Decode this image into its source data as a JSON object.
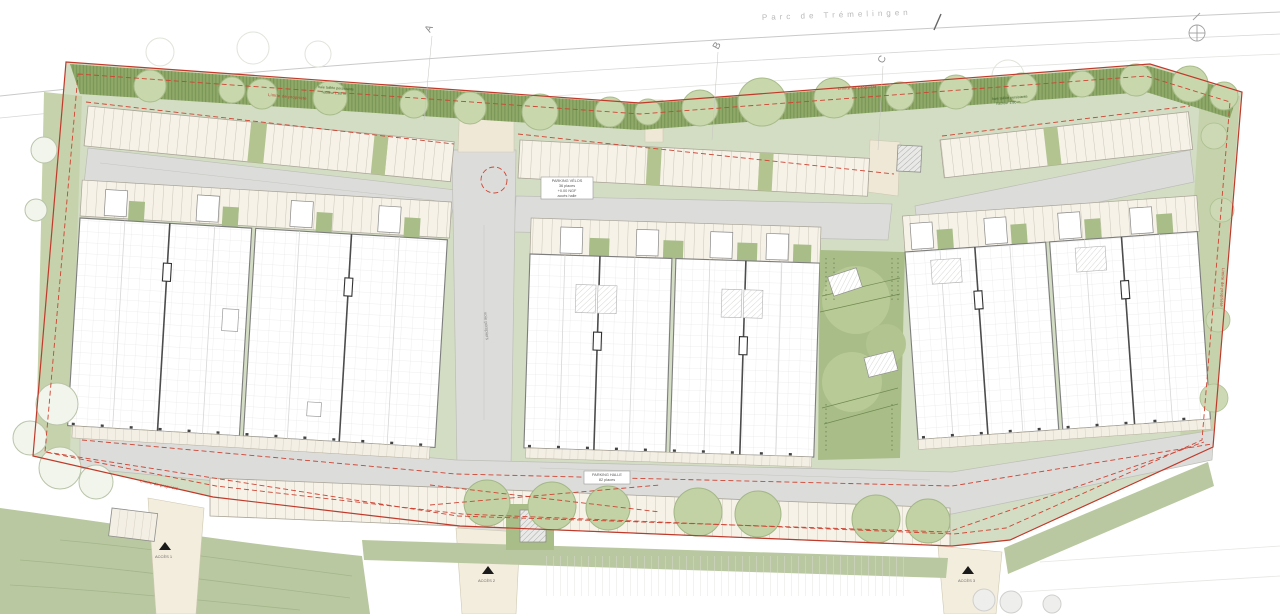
{
  "context": {
    "street_label": "Parc de Trémelingen"
  },
  "axes": [
    {
      "label": "A"
    },
    {
      "label": "B"
    },
    {
      "label": "C"
    }
  ],
  "boundary": {
    "property_line_label": "Limite de propriété",
    "color": "#bf3a2b"
  },
  "hedge_note": {
    "line1": "haie taillée persistante",
    "line2": "hauteur 1.80 m"
  },
  "road_label": "voie pompiers",
  "parking_note_top": {
    "line1": "PARKING VÉLOS",
    "line2": "36 places",
    "line3": "+0.00 NGF",
    "line4": "accès halle"
  },
  "parking_note_bottom": {
    "line1": "PARKING HALLE",
    "line2": "82 places"
  },
  "access_markers": [
    {
      "label": "ACCÈS 1"
    },
    {
      "label": "ACCÈS 2"
    },
    {
      "label": "ACCÈS 3"
    }
  ],
  "colors": {
    "site_base_green": "#d3ddc3",
    "hedge_green": "#8fa968",
    "courtyard_green": "#a9bd89",
    "tree_sage": "#c9d7ad",
    "road_gray": "#dcdcda",
    "stall_cream": "#f6f2e8",
    "hall_white": "#ffffff",
    "boundary_red": "#bf3a2b",
    "dashed_red": "#cf4433"
  }
}
